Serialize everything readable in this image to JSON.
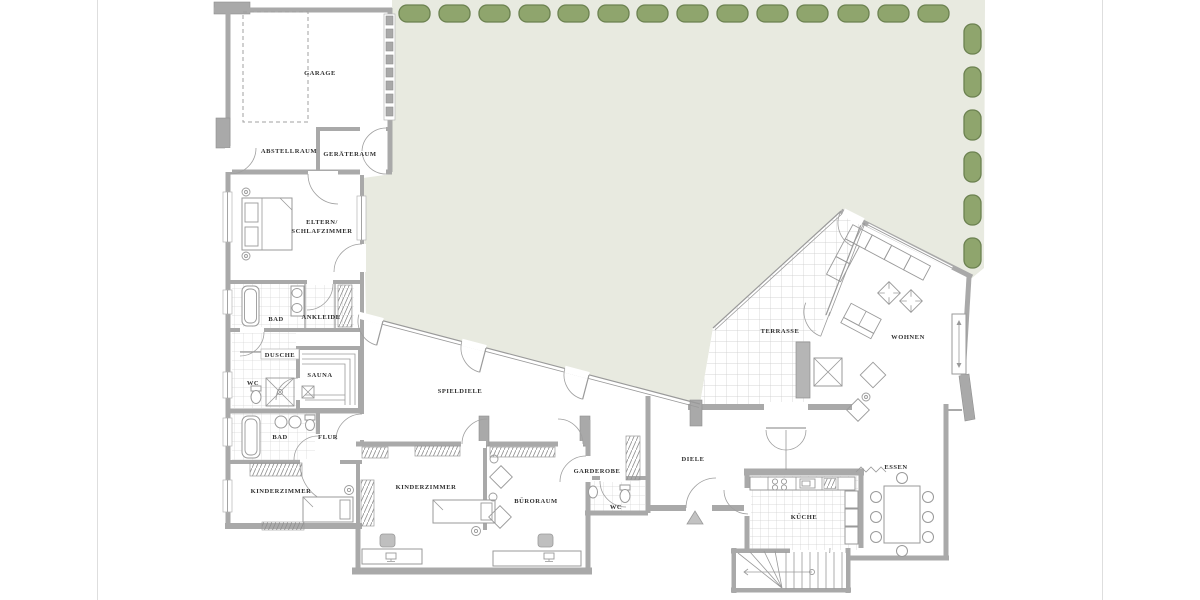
{
  "colors": {
    "lawn": "#e8eae0",
    "hedge": "#8fa56d",
    "hedgeBorder": "#6b8150",
    "wall": "#a9a9a9",
    "thin": "#9a9a9a",
    "text": "#2f2f2f",
    "tileSmall": "#d6d6d6",
    "tileLarge": "#c9c9c9"
  },
  "rooms": {
    "garage": {
      "label": "GARAGE"
    },
    "abstellraum": {
      "label": "ABSTELLRAUM"
    },
    "geraeteraum": {
      "label": "GERÄTERAUM"
    },
    "schlafzimmer": {
      "line1": "ELTERN/",
      "line2": "SCHLAFZIMMER"
    },
    "bad_og": {
      "label": "BAD"
    },
    "ankleide": {
      "label": "ANKLEIDE"
    },
    "dusche": {
      "label": "DUSCHE"
    },
    "wc_bad": {
      "label": "WC"
    },
    "sauna": {
      "label": "SAUNA"
    },
    "bad_kinder": {
      "label": "BAD"
    },
    "flur": {
      "label": "FLUR"
    },
    "spieldiele": {
      "label": "SPIELDIELE"
    },
    "kinderzimmer_west": {
      "label": "KINDERZIMMER"
    },
    "kinderzimmer_ost": {
      "label": "KINDERZIMMER"
    },
    "bueroraum": {
      "label": "BÜRORAUM"
    },
    "garderobe": {
      "label": "GARDEROBE"
    },
    "wc_diele": {
      "label": "WC"
    },
    "diele": {
      "label": "DIELE"
    },
    "kueche": {
      "label": "KÜCHE"
    },
    "essen": {
      "label": "ESSEN"
    },
    "terrasse": {
      "label": "TERRASSE"
    },
    "wohnen": {
      "label": "WOHNEN"
    }
  }
}
